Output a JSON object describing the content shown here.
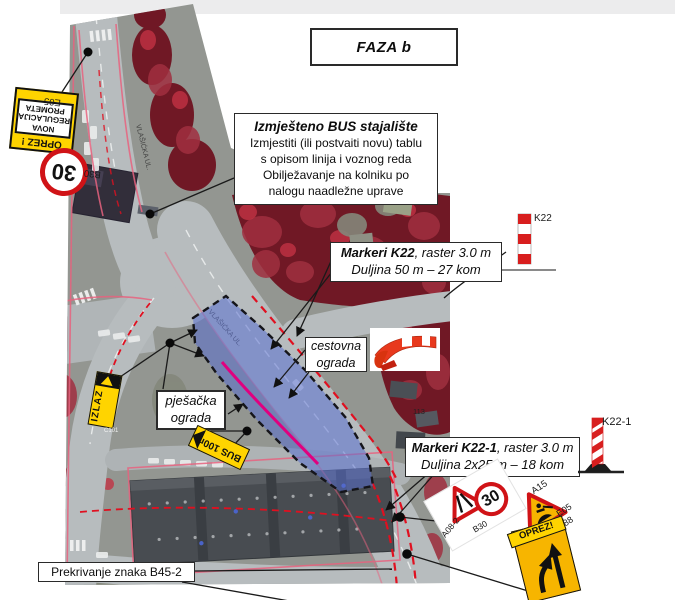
{
  "page": {
    "title_box": "FAZA b"
  },
  "boxes": {
    "bus_stop": {
      "title": "Izmješteno BUS stajalište",
      "lines": [
        "Izmjestiti (ili postvaiti novu) tablu",
        "s opisom linija i voznog reda",
        "Obilježavanje na kolniku po",
        "nalogu naadležne uprave"
      ]
    },
    "markers_k22": {
      "name": "Markeri K22",
      "suffix": ", raster 3.0 m",
      "line2": "Duljina 50 m – 27 kom"
    },
    "markers_k221": {
      "name": "Markeri K22-1",
      "suffix": ", raster 3.0 m",
      "line2": "Duljina 2x25 m – 18 kom"
    },
    "road_fence": {
      "line1": "cestovna",
      "line2": "ograda"
    },
    "ped_fence": {
      "line1": "pješačka",
      "line2": "ograda"
    },
    "cover": {
      "label": "Prekrivanje znaka B45-2"
    }
  },
  "signs": {
    "e05_top": {
      "code": "E05",
      "caption": "OPREZ !",
      "panel": [
        "NOVA",
        "REGULACIJA",
        "PROMETA"
      ]
    },
    "b30_top": {
      "code": "B30",
      "value": "30"
    },
    "exit": {
      "label": "IZLAZ",
      "code": "C101"
    },
    "bus": {
      "label": "BUS 100m"
    },
    "k22_post": {
      "code": "K22"
    },
    "k221_post": {
      "code": "K22-1"
    },
    "a082": {
      "code": "A08-2"
    },
    "b30_bottom": {
      "code": "B30",
      "value": "30"
    },
    "a15": {
      "code": "A15"
    },
    "e05_bottom": {
      "code": "E05"
    },
    "c88": {
      "code": "C88"
    },
    "oprez_panel": {
      "caption": "OPREZ!"
    }
  },
  "map_labels": {
    "street_top": "VLAŠIĆKA UL.",
    "street_diag": "VLAŠIĆKA UL.",
    "house": "113"
  },
  "colors": {
    "zone_fill": "#5a6fd0",
    "marker_red": "#e01020",
    "closure_magenta": "#e0007f",
    "sign_yellow": "#ffd400",
    "sign_red": "#d01317",
    "vegetation": "#701825"
  }
}
